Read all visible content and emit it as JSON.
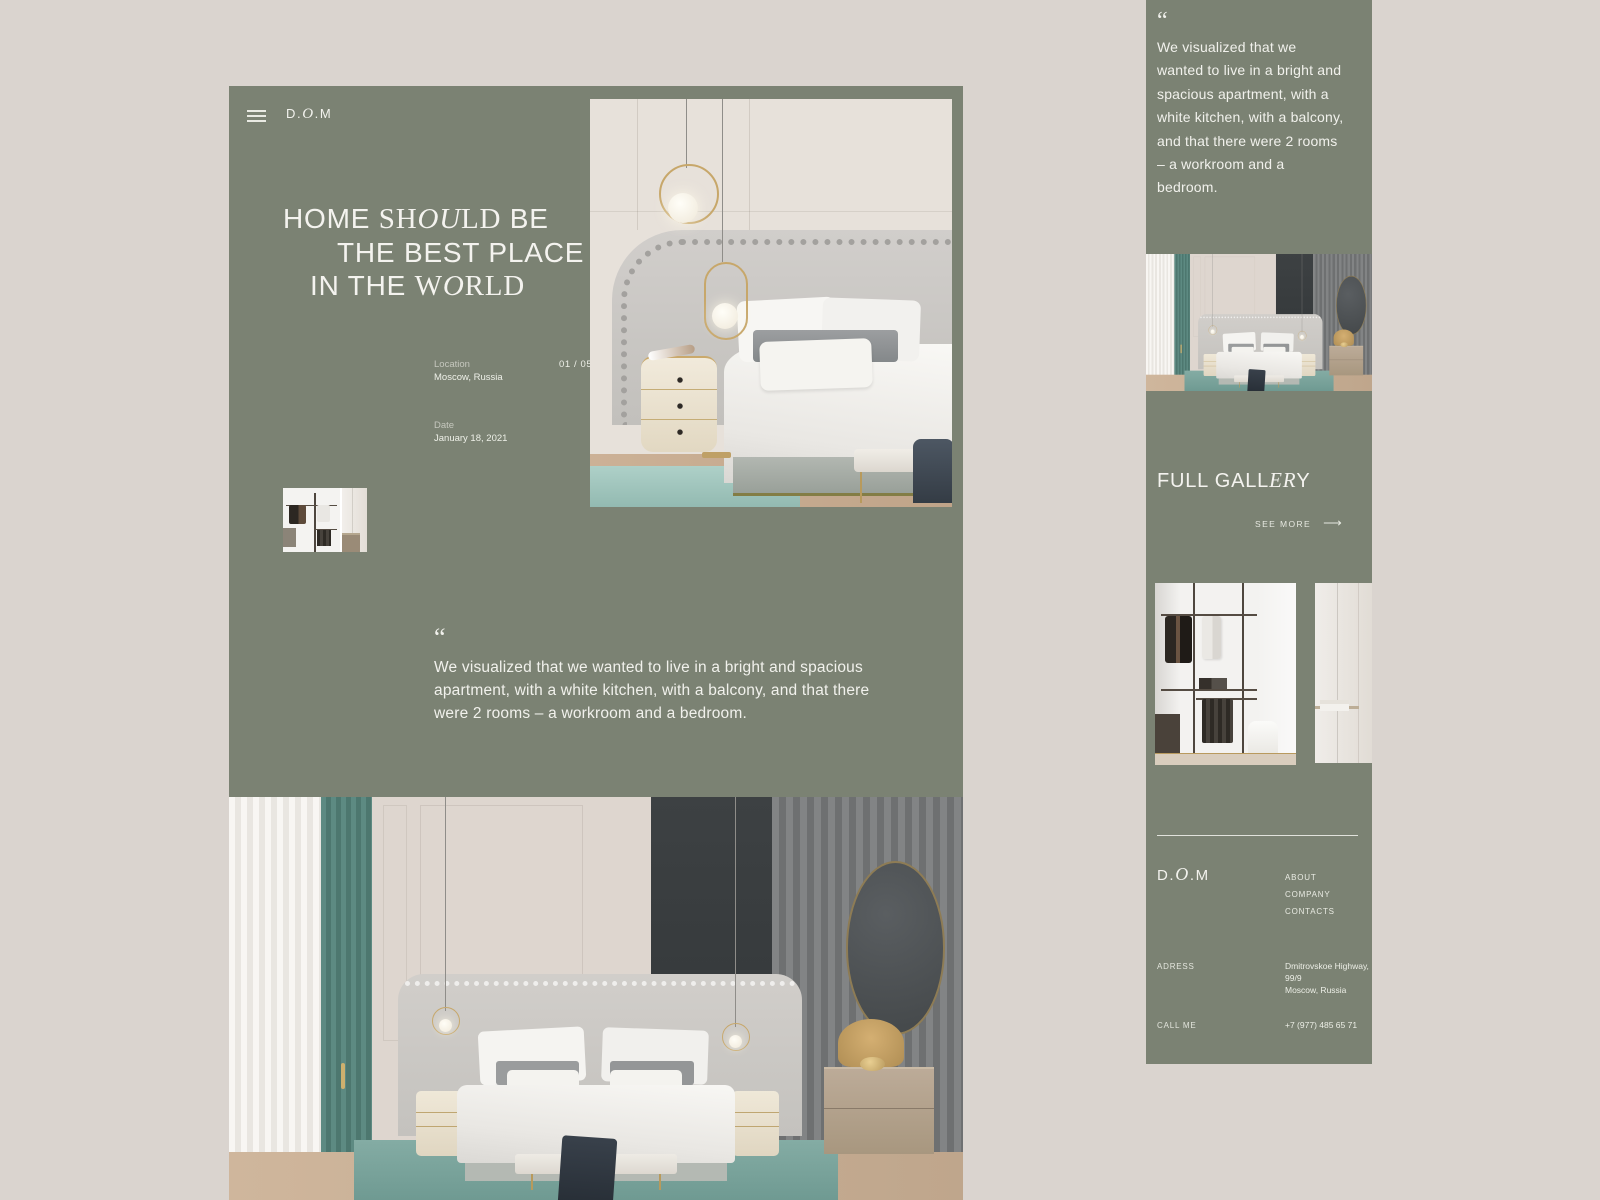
{
  "desktop": {
    "logo": {
      "d": "D.",
      "o": "O",
      "m": ".M"
    },
    "headline": {
      "l1_1": "HOME ",
      "l1_2": "SH",
      "l1_3": "OU",
      "l1_4": "LD",
      "l1_5": " BE",
      "l2": "THE BEST PLACE",
      "l3_1": "IN THE ",
      "l3_2": "W",
      "l3_3": "O",
      "l3_4": "RLD"
    },
    "meta": {
      "location_label": "Location",
      "location_value": "Moscow, Russia",
      "counter": "01 / 05",
      "date_label": "Date",
      "date_value": "January 18, 2021"
    },
    "quote": {
      "mark": "“",
      "text": "We visualized that we wanted to live in a bright and spacious apartment, with a white kitchen, with a balcony, and that there were 2 rooms – a workroom and a bedroom."
    }
  },
  "mobile": {
    "quote": {
      "mark": "“",
      "text": "We visualized that we wanted to live in a bright and spacious apartment, with a white kitchen, with a balcony, and that there were 2 rooms – a workroom and a bedroom."
    },
    "gallery": {
      "t1": "FULL GALL",
      "t2": "ER",
      "t3": "Y",
      "see_more": "SEE MORE",
      "arrow": "⟶"
    },
    "footer": {
      "logo": {
        "d": "D.",
        "o": "O",
        "m": ".M"
      },
      "links": [
        "ABOUT",
        "COMPANY",
        "CONTACTS"
      ],
      "address_label": "ADRESS",
      "address_lines": [
        "Dmitrovskoe Highway,",
        "99/9",
        "Moscow, Russia"
      ],
      "call_label": "CALL ME",
      "phone": "+7 (977) 485 65 71"
    }
  },
  "colors": {
    "background": "#dad4cf",
    "panel": "#7b8273",
    "text": "#f2f2ed",
    "gold": "#c7a76a",
    "teal_rug": "#7fa8a0"
  }
}
